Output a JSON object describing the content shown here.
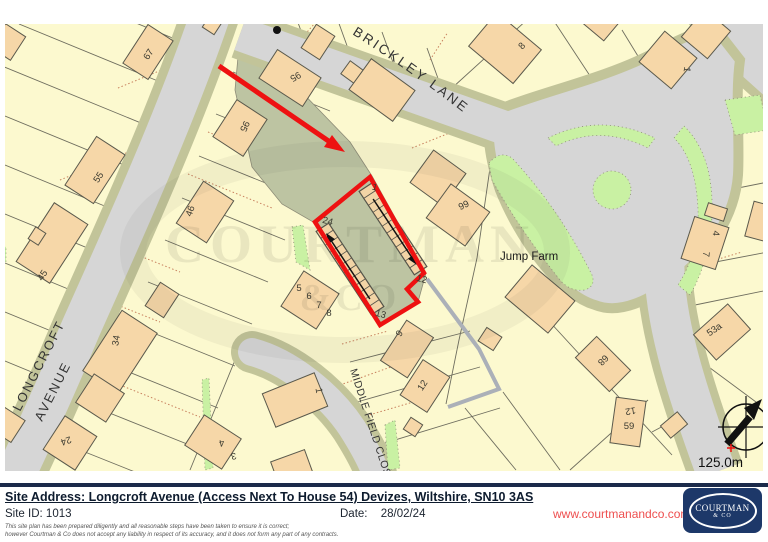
{
  "map": {
    "roads": {
      "brickley": "BRICKLEY LANE",
      "longcroft_line1": "LONGCROFT",
      "longcroft_line2": "AVENUE",
      "middle_field": "MIDDLE FIELD CLOSE"
    },
    "places": {
      "jump_farm": "Jump Farm"
    },
    "scale": "125.0m",
    "watermark_line1": "COURTMAN",
    "watermark_line2": "&CO",
    "icons": {
      "north_arrow": "compass-north-arrow",
      "survey_dot": "survey-point-dot"
    },
    "colors": {
      "parcel_yellow": "#FCF9CF",
      "building_peach": "#F6D7A8",
      "road_grey": "#D6D6D6",
      "verge_khaki": "#C2C499",
      "green": "#C9F1A3",
      "sage_track": "#BDC4A2",
      "plot_red": "#EE1111"
    },
    "house_numbers": [
      {
        "text": "67",
        "x": 151,
        "y": 56,
        "rot": -57
      },
      {
        "text": "95",
        "x": 294,
        "y": 74,
        "rot": 150
      },
      {
        "text": "95",
        "x": 242,
        "y": 125,
        "rot": 115
      },
      {
        "text": "55",
        "x": 101,
        "y": 179,
        "rot": -57
      },
      {
        "text": "46",
        "x": 193,
        "y": 212,
        "rot": -70
      },
      {
        "text": "45",
        "x": 45,
        "y": 277,
        "rot": -57
      },
      {
        "text": "34",
        "x": 119,
        "y": 341,
        "rot": -80
      },
      {
        "text": "24",
        "x": 65,
        "y": 438,
        "rot": 160
      },
      {
        "text": "4",
        "x": 221,
        "y": 440,
        "rot": 168,
        "size": 8.5
      },
      {
        "text": "3",
        "x": 233,
        "y": 453,
        "rot": 168,
        "size": 8.5
      },
      {
        "text": "24",
        "x": 327,
        "y": 224,
        "rot": 15,
        "size": 8.5
      },
      {
        "text": "1",
        "x": 374,
        "y": 190,
        "rot": 15,
        "size": 8.5
      },
      {
        "text": "13",
        "x": 380,
        "y": 317,
        "rot": 15,
        "size": 8.5
      },
      {
        "text": "12",
        "x": 421,
        "y": 282,
        "rot": 15,
        "size": 8.5
      },
      {
        "text": "5",
        "x": 299,
        "y": 291,
        "rot": 0,
        "size": 8.5
      },
      {
        "text": "6",
        "x": 309,
        "y": 299,
        "rot": 0,
        "size": 8.5
      },
      {
        "text": "7",
        "x": 319,
        "y": 308,
        "rot": 0,
        "size": 8.5
      },
      {
        "text": "8",
        "x": 329,
        "y": 316,
        "rot": 0,
        "size": 8.5
      },
      {
        "text": "99",
        "x": 465,
        "y": 208,
        "rot": -25
      },
      {
        "text": "9",
        "x": 402,
        "y": 335,
        "rot": -57
      },
      {
        "text": "12",
        "x": 425,
        "y": 387,
        "rot": -57
      },
      {
        "text": "1",
        "x": 316,
        "y": 391,
        "rot": 80
      },
      {
        "text": "8",
        "x": 524,
        "y": 48,
        "rot": -47
      },
      {
        "text": "1",
        "x": 684,
        "y": 69,
        "rot": 100
      },
      {
        "text": "4",
        "x": 713,
        "y": 233,
        "rot": 95
      },
      {
        "text": "7",
        "x": 703,
        "y": 254,
        "rot": 95
      },
      {
        "text": "53a",
        "x": 716,
        "y": 332,
        "rot": -35
      },
      {
        "text": "68",
        "x": 601,
        "y": 358,
        "rot": 135
      },
      {
        "text": "12",
        "x": 630,
        "y": 408,
        "rot": 170
      },
      {
        "text": "59",
        "x": 629,
        "y": 429,
        "rot": 0
      }
    ]
  },
  "footer": {
    "site_address": "Site Address: Longcroft Avenue (Access Next To House 54) Devizes, Wiltshire, SN10 3AS",
    "site_id_label": "Site ID:",
    "site_id": "1013",
    "date_label": "Date:",
    "date": "28/02/24",
    "disclaimer_line1": "This site plan has been prepared diligently and all reasonable steps have been taken to ensure it is correct;",
    "disclaimer_line2": "however Courtman & Co does not accept any liability in respect of its accuracy, and it does not form any part of any contracts.",
    "website": "www.courtmanandco.com",
    "logo_line1": "COURTMAN",
    "logo_line2": "& CO",
    "colors": {
      "rule_navy": "#1b2a4a",
      "logo_navy": "#1d3869",
      "link_red": "#ee4f4f"
    }
  }
}
